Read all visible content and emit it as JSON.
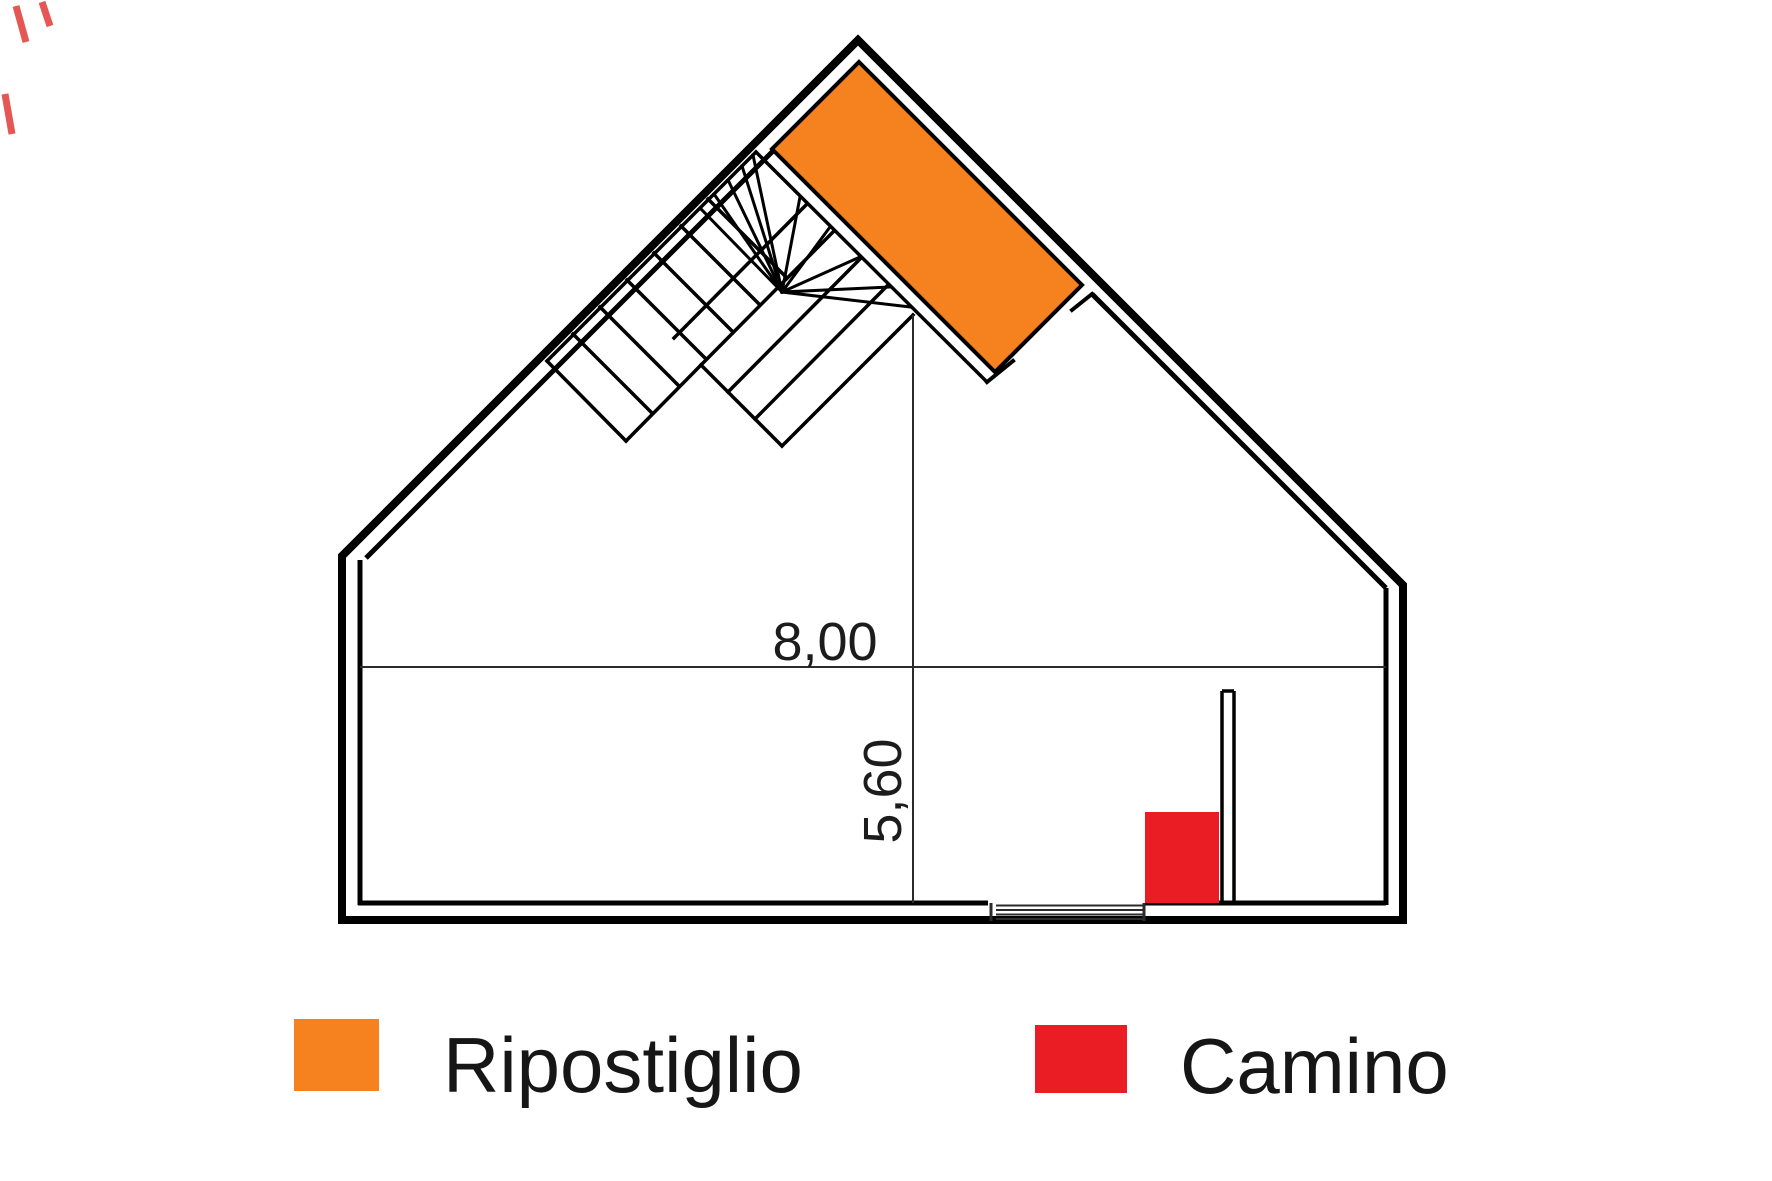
{
  "plan": {
    "width_dimension": "8,00",
    "height_dimension": "5,60",
    "rooms": {
      "ripostiglio": {
        "name": "Ripostiglio",
        "color": "#F5821F"
      },
      "camino": {
        "name": "Camino",
        "color": "#EA1C24"
      }
    }
  },
  "legend": {
    "items": [
      {
        "label": "Ripostiglio",
        "color": "#F5821F"
      },
      {
        "label": "Camino",
        "color": "#EA1C24"
      }
    ]
  },
  "colors": {
    "wall": "#000000",
    "dimension": "#2b2b2b",
    "background": "#ffffff"
  }
}
